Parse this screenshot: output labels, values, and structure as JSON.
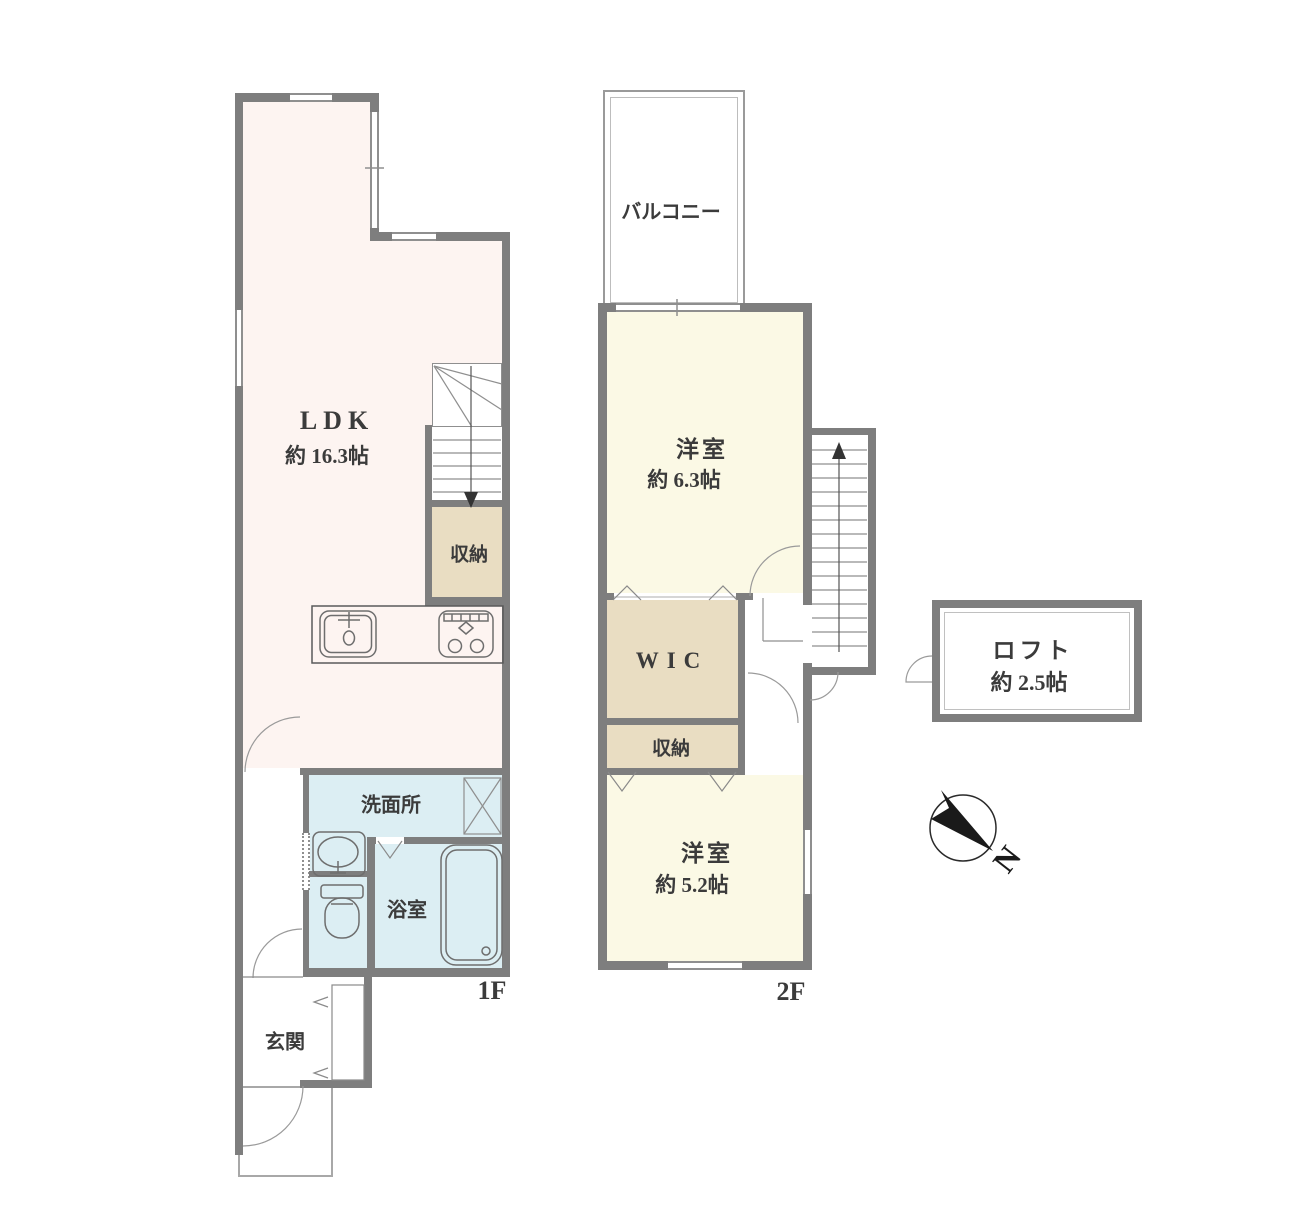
{
  "plan": {
    "floor1": {
      "floor_label": "1F",
      "ldk": {
        "name": "LDK",
        "size": "約 16.3帖"
      },
      "storage": "収納",
      "washroom": "洗面所",
      "bathroom": "浴室",
      "entrance": "玄関"
    },
    "floor2": {
      "floor_label": "2F",
      "balcony": "バルコニー",
      "bedroom1": {
        "name": "洋室",
        "size": "約 6.3帖"
      },
      "wic": "WIC",
      "storage": "収納",
      "bedroom2": {
        "name": "洋室",
        "size": "約 5.2帖"
      }
    },
    "loft": {
      "name": "ロフト",
      "size": "約 2.5帖"
    },
    "compass": {
      "label": "N"
    }
  },
  "colors": {
    "wall": "#7e7e7e",
    "line": "#8f8f8f",
    "text": "#3b3b3b",
    "ldk_fill": "#fdf4f1",
    "bedroom_fill": "#fbf9e5",
    "closet_fill": "#e9ddc2",
    "wet_fill": "#dceef3"
  }
}
